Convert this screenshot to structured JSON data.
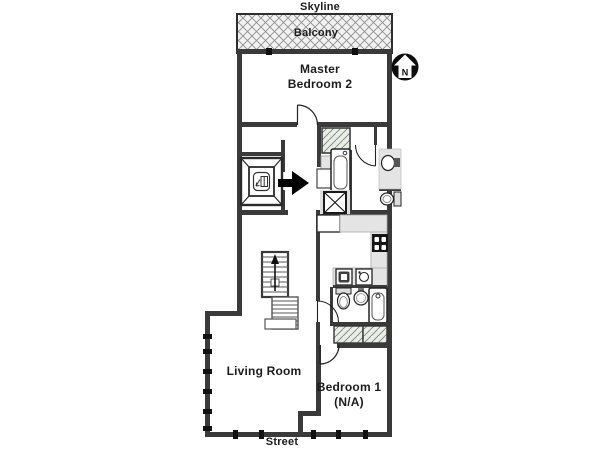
{
  "plan": {
    "skyline_label": "Skyline",
    "balcony_label": "Balcony",
    "master_bedroom_line1": "Master",
    "master_bedroom_line2": "Bedroom 2",
    "living_room_label": "Living Room",
    "bedroom1_line1": "Bedroom 1",
    "bedroom1_line2": "(N/A)",
    "street_label": "Street",
    "compass_letter": "N"
  },
  "colors": {
    "background": "#ffffff",
    "wall": "#3a3a3a",
    "line": "#1f1f1f",
    "counter_fill": "#e4e4e4",
    "hatch_fill": "#e9efe6",
    "balcony_fill": "#f2f2f2",
    "arrow": "#000000",
    "compass": "#0d0d0d"
  },
  "icons": {
    "north-compass-icon": "black circle with white up-arrow house and letter N",
    "elevator-icon": "beveled shaft square with elevator call glyph",
    "entrance-arrow-icon": "solid black arrow pointing right into entry",
    "stairs-icon": "two stair flights with up direction arrow",
    "bathtub-icon": "rounded tub outline",
    "toilet-icon": "bowl with tank",
    "sink-icon": "basin circle",
    "stove-icon": "black range with four burners",
    "shaft-x-icon": "square crossed with X",
    "door-arc": "quarter-circle door swing",
    "window-marker": "black tick on exterior wall",
    "closet-hatch": "diagonal hatched closet",
    "balcony-hatch": "cross hatched balcony deck"
  }
}
